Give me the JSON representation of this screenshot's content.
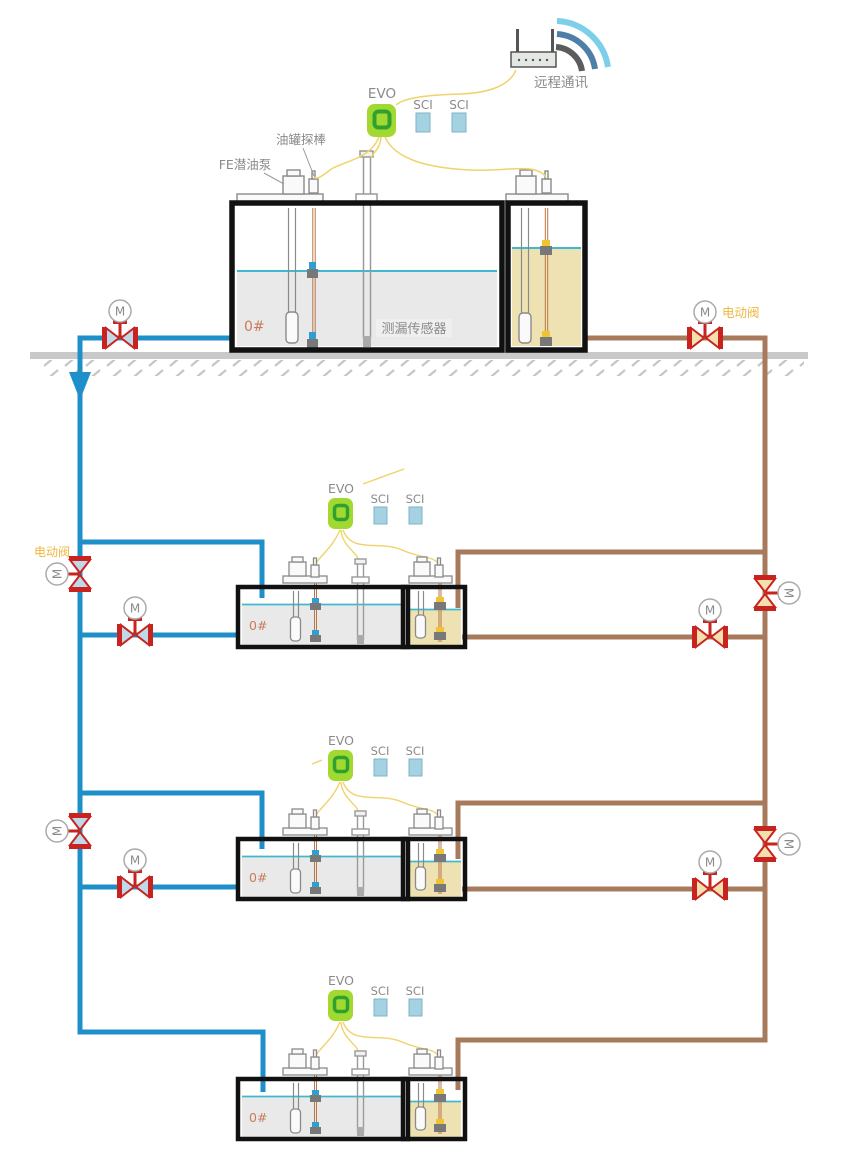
{
  "diagram": {
    "description": "Fuel station tank monitoring and piping schematic: one above-ground station tank and three underground tanks, each with EVO console, SCI modules, submersible pump, tank probe and leak sensor, linked by motorized valves on supply (blue) and return (brown) pipelines",
    "labels": {
      "remote_comm": "远程通讯",
      "controller": "EVO",
      "interface_module": "SCI",
      "tank_probe": "油罐探棒",
      "submersible_pump": "FE潜油泵",
      "leak_sensor": "测漏传感器",
      "fuel_grade": "0#",
      "electric_valve": "电动阀",
      "motor": "M"
    },
    "components": {
      "above_ground_tanks": 1,
      "underground_tanks": 3,
      "evo_controllers": 4,
      "sci_modules_per_controller": 2,
      "motorized_valves": 10
    },
    "colors": {
      "pipe_blue": "#1f8fca",
      "pipe_brown": "#a87a5c",
      "valve_red": "#c8231e",
      "valve_fill_blue": "#bfd9ea",
      "valve_fill_tan": "#f4dfae",
      "evo_green": "#a2d930",
      "evo_ring_green": "#2fa12f",
      "sci_blue": "#a5d2e2",
      "fluid_gray": "#e9e9e9",
      "fluid_tan": "#efe2b2",
      "fluid_surface_teal": "#3fb9cf",
      "cable_yellow": "#efd36b",
      "label_gray": "#8a8a8a",
      "label_orange": "#efb73e",
      "grade_label": "#c87b5b",
      "ground_gray": "#c9c9c9",
      "tank_outline": "#111111"
    }
  }
}
